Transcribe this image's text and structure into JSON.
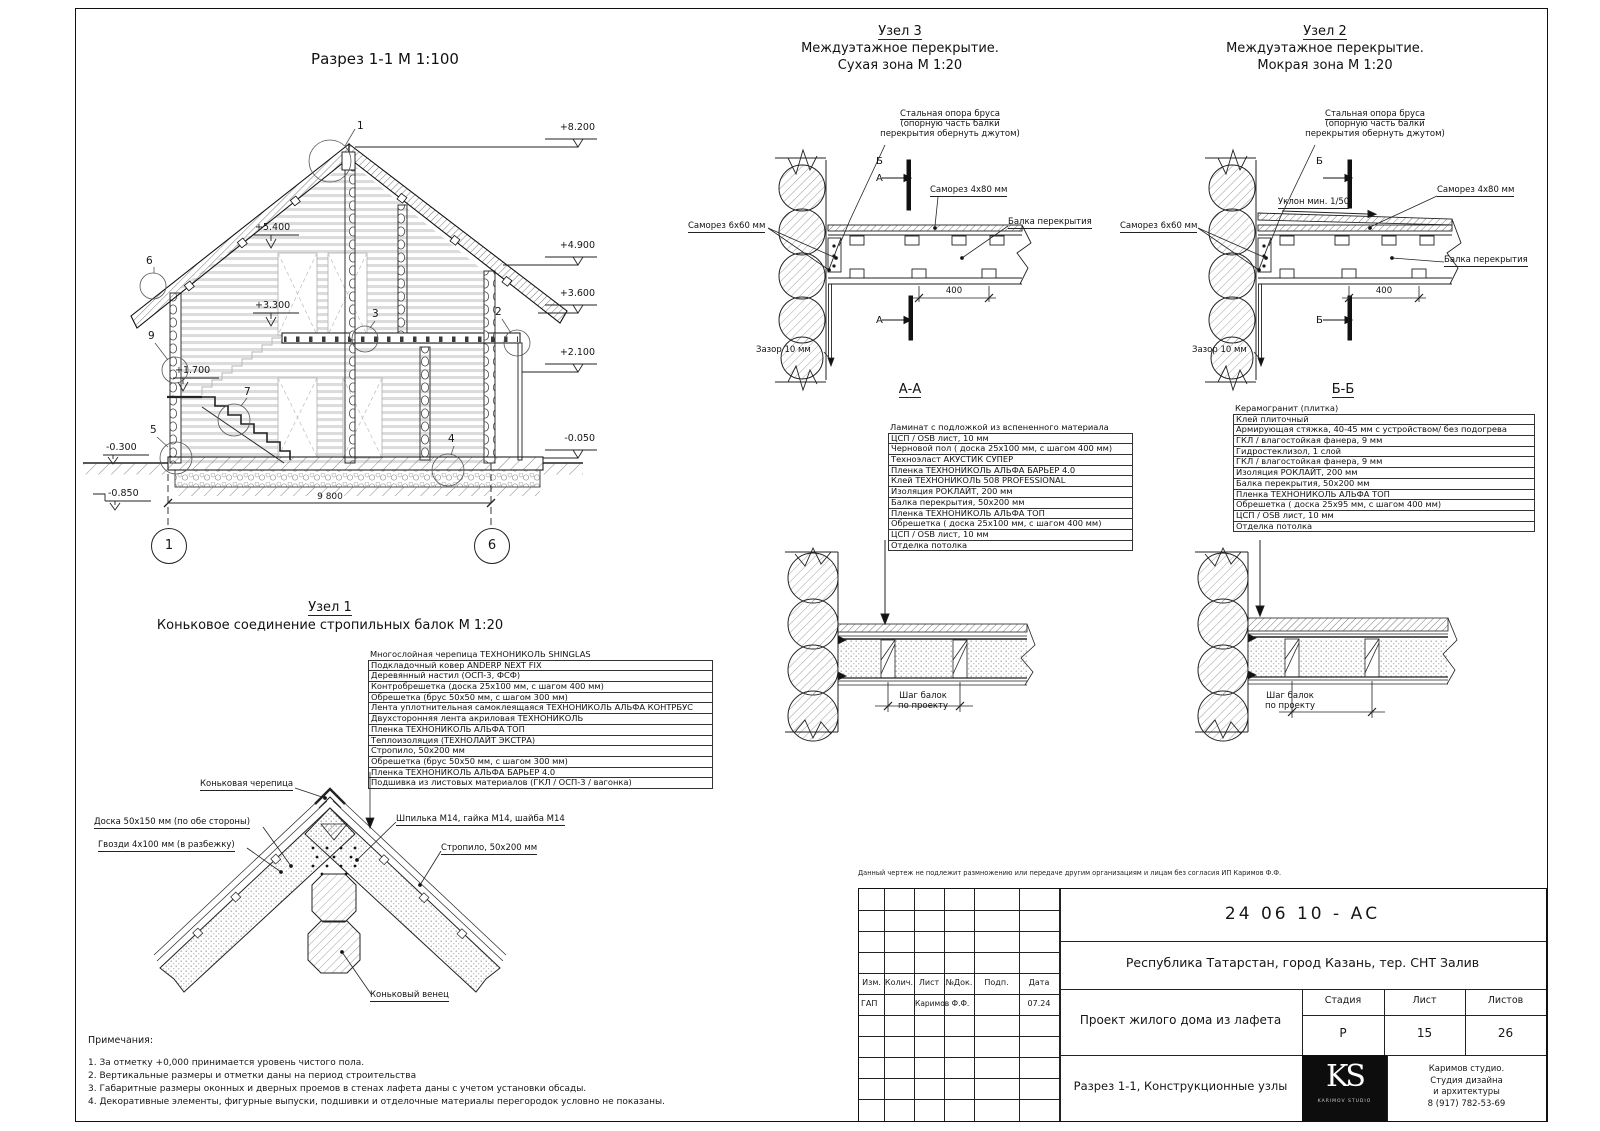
{
  "razrez": {
    "title": "Разрез 1-1 М 1:100",
    "e8200": "+8.200",
    "e5400": "+5.400",
    "e4900": "+4.900",
    "e3600": "+3.600",
    "e3300": "+3.300",
    "e2100": "+2.100",
    "e1700": "+1.700",
    "em0300": "-0.300",
    "em0050": "-0.050",
    "em0850": "-0.850",
    "dim_total": "9 800",
    "axis1": "1",
    "axis6": "6",
    "c1": "1",
    "c2": "2",
    "c3": "3",
    "c4": "4",
    "c5": "5",
    "c6": "6",
    "c7": "7",
    "c9": "9"
  },
  "node3": {
    "title": "Узел 3",
    "sub1": "Междуэтажное перекрытие.",
    "sub2": "Сухая зона М 1:20",
    "support1": "Стальная опора бруса",
    "support2": "(опорную часть балки",
    "support3": "перекрытия обернуть джутом)",
    "screw480": "Саморез 4х80 мм",
    "screw660": "Саморез 6х60 мм",
    "beam": "Балка перекрытия",
    "gap": "Зазор 10 мм",
    "dim400": "400",
    "mA": "А",
    "mB": "Б",
    "section": "А-А"
  },
  "node2": {
    "title": "Узел 2",
    "sub1": "Междуэтажное перекрытие.",
    "sub2": "Мокрая зона М 1:20",
    "support1": "Стальная опора бруса",
    "support2": "(опорную часть балки",
    "support3": "перекрытия обернуть джутом)",
    "screw480": "Саморез 4х80 мм",
    "screw660": "Саморез 6х60 мм",
    "beam": "Балка перекрытия",
    "gap": "Зазор 10 мм",
    "slope": "Уклон мин. 1/50",
    "dim400": "400",
    "mB": "Б",
    "section": "Б-Б"
  },
  "aa": {
    "layers": [
      "Ламинат  с подложкой из вспененного материала",
      "ЦСП / OSB лист, 10 мм",
      "Черновой пол ( доска 25х100 мм, с шагом 400 мм)",
      "Техноэласт АКУСТИК СУПЕР",
      "Пленка ТЕХНОНИКОЛЬ АЛЬФА БАРЬЕР 4.0",
      "Клей ТЕХНОНИКОЛЬ 508 PROFESSIONAL",
      "Изоляция РОКЛАЙТ, 200 мм",
      "Балка перекрытия, 50х200 мм",
      "Пленка ТЕХНОНИКОЛЬ АЛЬФА ТОП",
      "Обрешетка ( доска 25х100 мм, с шагом 400 мм)",
      "ЦСП / OSB лист, 10 мм",
      "Отделка потолка"
    ],
    "step1": "Шаг балок",
    "step2": "по проекту"
  },
  "bb": {
    "layers": [
      "Керамогранит (плитка)",
      "Клей плиточный",
      "Армирующая стяжка, 40-45 мм с устройством/ без подогрева",
      "ГКЛ / влагостойкая фанера, 9 мм",
      "Гидростеклизол, 1 слой",
      "ГКЛ / влагостойкая фанера, 9 мм",
      "Изоляция РОКЛАЙТ, 200 мм",
      "Балка перекрытия, 50х200 мм",
      "Пленка ТЕХНОНИКОЛЬ АЛЬФА ТОП",
      "Обрешетка ( доска 25х95 мм, с шагом 400 мм)",
      "ЦСП / OSB лист, 10 мм",
      "Отделка потолка"
    ],
    "step1": "Шаг балок",
    "step2": "по проекту"
  },
  "node1": {
    "title": "Узел 1",
    "subtitle": "Коньковое соединение стропильных балок М 1:20",
    "layers": [
      "Многослойная черепица ТЕХНОНИКОЛЬ SHINGLAS",
      "Подкладочный ковер ANDERP NEXT FIX",
      "Деревянный настил (ОСП-3, ФСФ)",
      "Контробрешетка (доска 25х100 мм, с шагом 400 мм)",
      "Обрешетка (брус 50х50 мм, с шагом 300 мм)",
      "Лента уплотнительная самоклеящаяся ТЕХНОНИКОЛЬ АЛЬФА КОНТРБУС",
      "Двухсторонняя лента акриловая ТЕХНОНИКОЛЬ",
      "Пленка ТЕХНОНИКОЛЬ АЛЬФА ТОП",
      "Теплоизоляция (ТЕХНОЛАЙТ ЭКСТРА)",
      "Стропило, 50х200 мм",
      "Обрешетка (брус 50х50 мм, с шагом 300 мм)",
      "Пленка ТЕХНОНИКОЛЬ АЛЬФА БАРЬЕР 4.0",
      "Подшивка из листовых материалов (ГКЛ / ОСП-3 / вагонка)"
    ],
    "ridge_tile": "Коньковая черепица",
    "board": "Доска 50х150 мм (по обе стороны)",
    "nails": "Гвозди 4х100 мм (в разбежку)",
    "stud": "Шпилька М14, гайка М14, шайба М14",
    "rafter": "Стропило, 50х200 мм",
    "ridge_log": "Коньковый венец"
  },
  "notes": {
    "title": "Примечания:",
    "n1": "1. За отметку +0,000 принимается уровень чистого пола.",
    "n2": "2. Вертикальные размеры и отметки даны на период строительства",
    "n3": "3. Габаритные размеры оконных и дверных проемов в стенах лафета даны с учетом установки обсады.",
    "n4": "4. Декоративные элементы, фигурные выпуски, подшивки и отделочные материалы перегородок условно не показаны."
  },
  "tb": {
    "disclaimer": "Данный чертеж не подлежит размножению или передаче другим организациям и лицам без согласия ИП Каримов Ф.Ф.",
    "doc": "24 06 10 - АС",
    "location": "Республика Татарстан, город Казань, тер. СНТ Залив",
    "cIzm": "Изм.",
    "cKol": "Колич.",
    "cList": "Лист",
    "cDok": "№Док.",
    "cPodp": "Подп.",
    "cData": "Дата",
    "role": "ГАП",
    "name": "Каримов Ф.Ф.",
    "date": "07.24",
    "project": "Проект жилого дома из лафета",
    "stageL": "Стадия",
    "listL": "Лист",
    "listovL": "Листов",
    "stage": "Р",
    "list": "15",
    "listov": "26",
    "title": "Разрез 1-1, Конструкционные узлы",
    "logo": "KS",
    "logoSub": "KARIMOV STUDIO",
    "s1": "Каримов студио.",
    "s2": "Студия дизайна",
    "s3": "и архитектуры",
    "s4": "8 (917) 782-53-69"
  }
}
